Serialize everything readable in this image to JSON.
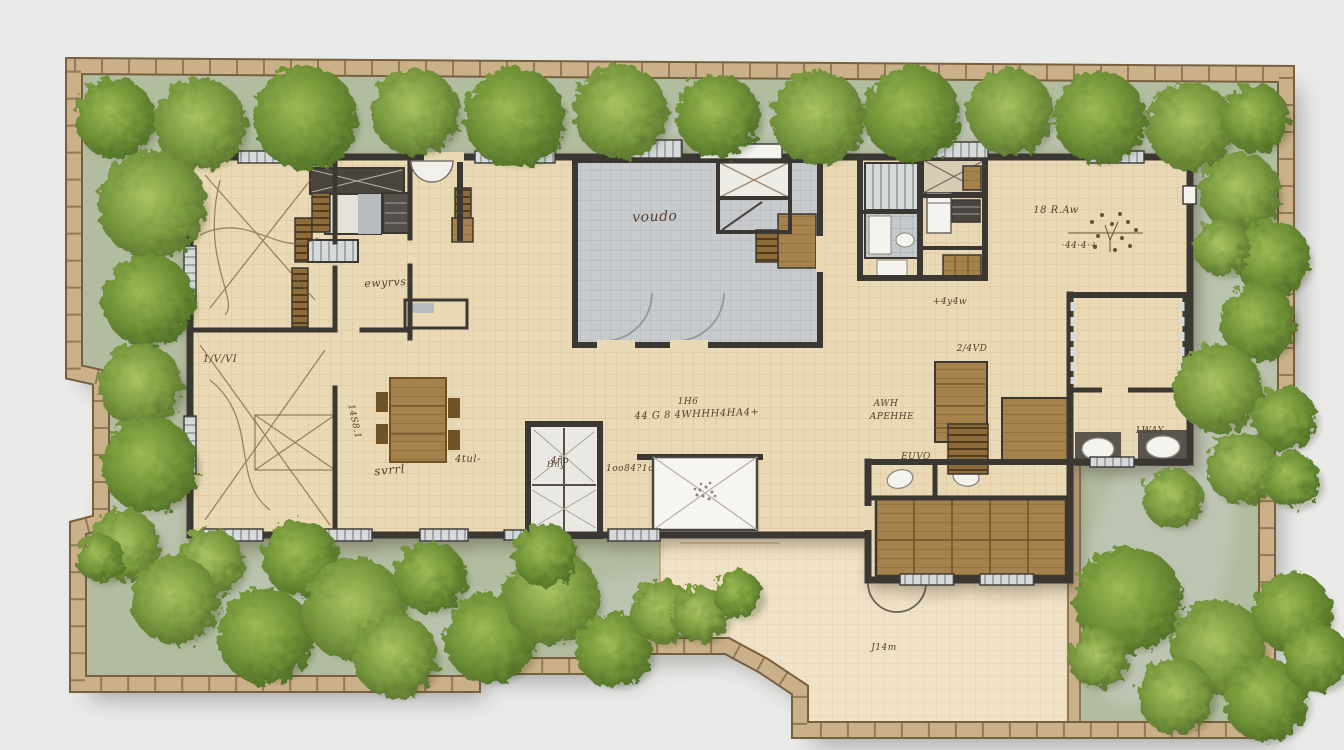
{
  "colors": {
    "page_bg": "#eaeae8",
    "ground": "#b2bc9f",
    "patch": "#c6c9c0",
    "fence_fill": "#cbb189",
    "fence_edge": "#77603e",
    "wall": "#3b3833",
    "floor": "#ead9b5",
    "terrace": "#efe2c6",
    "grayroom": "#c8cbce",
    "window": "#d7dadb",
    "wood": "#a5814b",
    "wood_dark": "#6f5327",
    "white_fix": "#f4f3ee",
    "ink": "#54402c",
    "tree_light": "#9dbb55",
    "tree_mid": "#6f9136",
    "tree_dark": "#4f6e28"
  },
  "annotations": [
    {
      "text": "voudo",
      "x": 655,
      "y": 221,
      "s": 14,
      "r": -2
    },
    {
      "text": "18 R.Aw",
      "x": 1056,
      "y": 213,
      "s": 10,
      "r": 0
    },
    {
      "text": "·44·4·+",
      "x": 1080,
      "y": 248,
      "s": 9,
      "r": 0
    },
    {
      "text": "ewyrvst",
      "x": 388,
      "y": 286,
      "s": 11,
      "r": -3
    },
    {
      "text": "1/V/VI",
      "x": 220,
      "y": 362,
      "s": 10,
      "r": 0
    },
    {
      "text": "1H6",
      "x": 688,
      "y": 404,
      "s": 9,
      "r": 0
    },
    {
      "text": "44 G 8 4WHHH4HA4+",
      "x": 697,
      "y": 417,
      "s": 10,
      "r": -2
    },
    {
      "text": "AWH",
      "x": 886,
      "y": 406,
      "s": 9,
      "r": 0
    },
    {
      "text": "APEHHE",
      "x": 892,
      "y": 419,
      "s": 9,
      "r": 0
    },
    {
      "text": "EUVO",
      "x": 916,
      "y": 459,
      "s": 9,
      "r": 0
    },
    {
      "text": "LWAY",
      "x": 1150,
      "y": 433,
      "s": 9,
      "r": 0
    },
    {
      "text": "svrrl",
      "x": 390,
      "y": 474,
      "s": 12,
      "r": -5
    },
    {
      "text": "4tul-",
      "x": 468,
      "y": 462,
      "s": 10,
      "r": 0
    },
    {
      "text": "2/4VD",
      "x": 972,
      "y": 351,
      "s": 9,
      "r": 0
    },
    {
      "text": "J14m",
      "x": 884,
      "y": 650,
      "s": 9,
      "r": 0
    },
    {
      "text": "14S8.1",
      "x": 352,
      "y": 422,
      "s": 9,
      "r": 78
    },
    {
      "text": "4ño",
      "x": 560,
      "y": 463,
      "s": 9,
      "r": 0
    },
    {
      "text": "1oo84?1o",
      "x": 630,
      "y": 471,
      "s": 9,
      "r": 0
    },
    {
      "text": "+4y4w",
      "x": 950,
      "y": 304,
      "s": 9,
      "r": 0
    },
    {
      "text": "Hny",
      "x": 556,
      "y": 467,
      "s": 8,
      "r": 0
    }
  ],
  "trees": [
    [
      115,
      118,
      40
    ],
    [
      200,
      124,
      46
    ],
    [
      305,
      118,
      52
    ],
    [
      415,
      112,
      44
    ],
    [
      515,
      118,
      50
    ],
    [
      620,
      112,
      47
    ],
    [
      718,
      116,
      42
    ],
    [
      818,
      118,
      47
    ],
    [
      912,
      114,
      48
    ],
    [
      1010,
      112,
      43
    ],
    [
      1100,
      118,
      46
    ],
    [
      1190,
      126,
      44
    ],
    [
      1255,
      118,
      34
    ],
    [
      1240,
      192,
      40
    ],
    [
      1272,
      258,
      38
    ],
    [
      1222,
      248,
      28
    ],
    [
      1258,
      322,
      38
    ],
    [
      1218,
      388,
      44
    ],
    [
      1284,
      418,
      32
    ],
    [
      1242,
      468,
      36
    ],
    [
      1292,
      480,
      28
    ],
    [
      1172,
      498,
      30
    ],
    [
      1128,
      600,
      54
    ],
    [
      1218,
      648,
      48
    ],
    [
      1292,
      612,
      40
    ],
    [
      1176,
      696,
      38
    ],
    [
      1266,
      700,
      42
    ],
    [
      1098,
      658,
      30
    ],
    [
      1316,
      658,
      34
    ],
    [
      152,
      205,
      54
    ],
    [
      148,
      300,
      46
    ],
    [
      140,
      385,
      42
    ],
    [
      150,
      465,
      48
    ],
    [
      124,
      545,
      36
    ],
    [
      100,
      558,
      24
    ],
    [
      210,
      562,
      34
    ],
    [
      300,
      558,
      38
    ],
    [
      175,
      600,
      44
    ],
    [
      265,
      636,
      48
    ],
    [
      355,
      610,
      52
    ],
    [
      430,
      577,
      36
    ],
    [
      395,
      656,
      42
    ],
    [
      490,
      638,
      46
    ],
    [
      552,
      597,
      48
    ],
    [
      614,
      650,
      38
    ],
    [
      662,
      612,
      32
    ],
    [
      545,
      555,
      32
    ],
    [
      700,
      614,
      28
    ],
    [
      738,
      594,
      24
    ]
  ],
  "ground_patches": [
    [
      940,
      128,
      330,
      20,
      0,
      0.5
    ],
    [
      1158,
      560,
      70,
      150,
      15,
      0.6
    ],
    [
      1240,
      330,
      45,
      120,
      0,
      0.45
    ],
    [
      660,
      618,
      95,
      48,
      0,
      0.5
    ],
    [
      300,
      598,
      80,
      42,
      0,
      0.45
    ],
    [
      480,
      625,
      65,
      35,
      0,
      0.4
    ],
    [
      140,
      520,
      45,
      65,
      0,
      0.4
    ],
    [
      1200,
      210,
      60,
      40,
      0,
      0.4
    ]
  ]
}
